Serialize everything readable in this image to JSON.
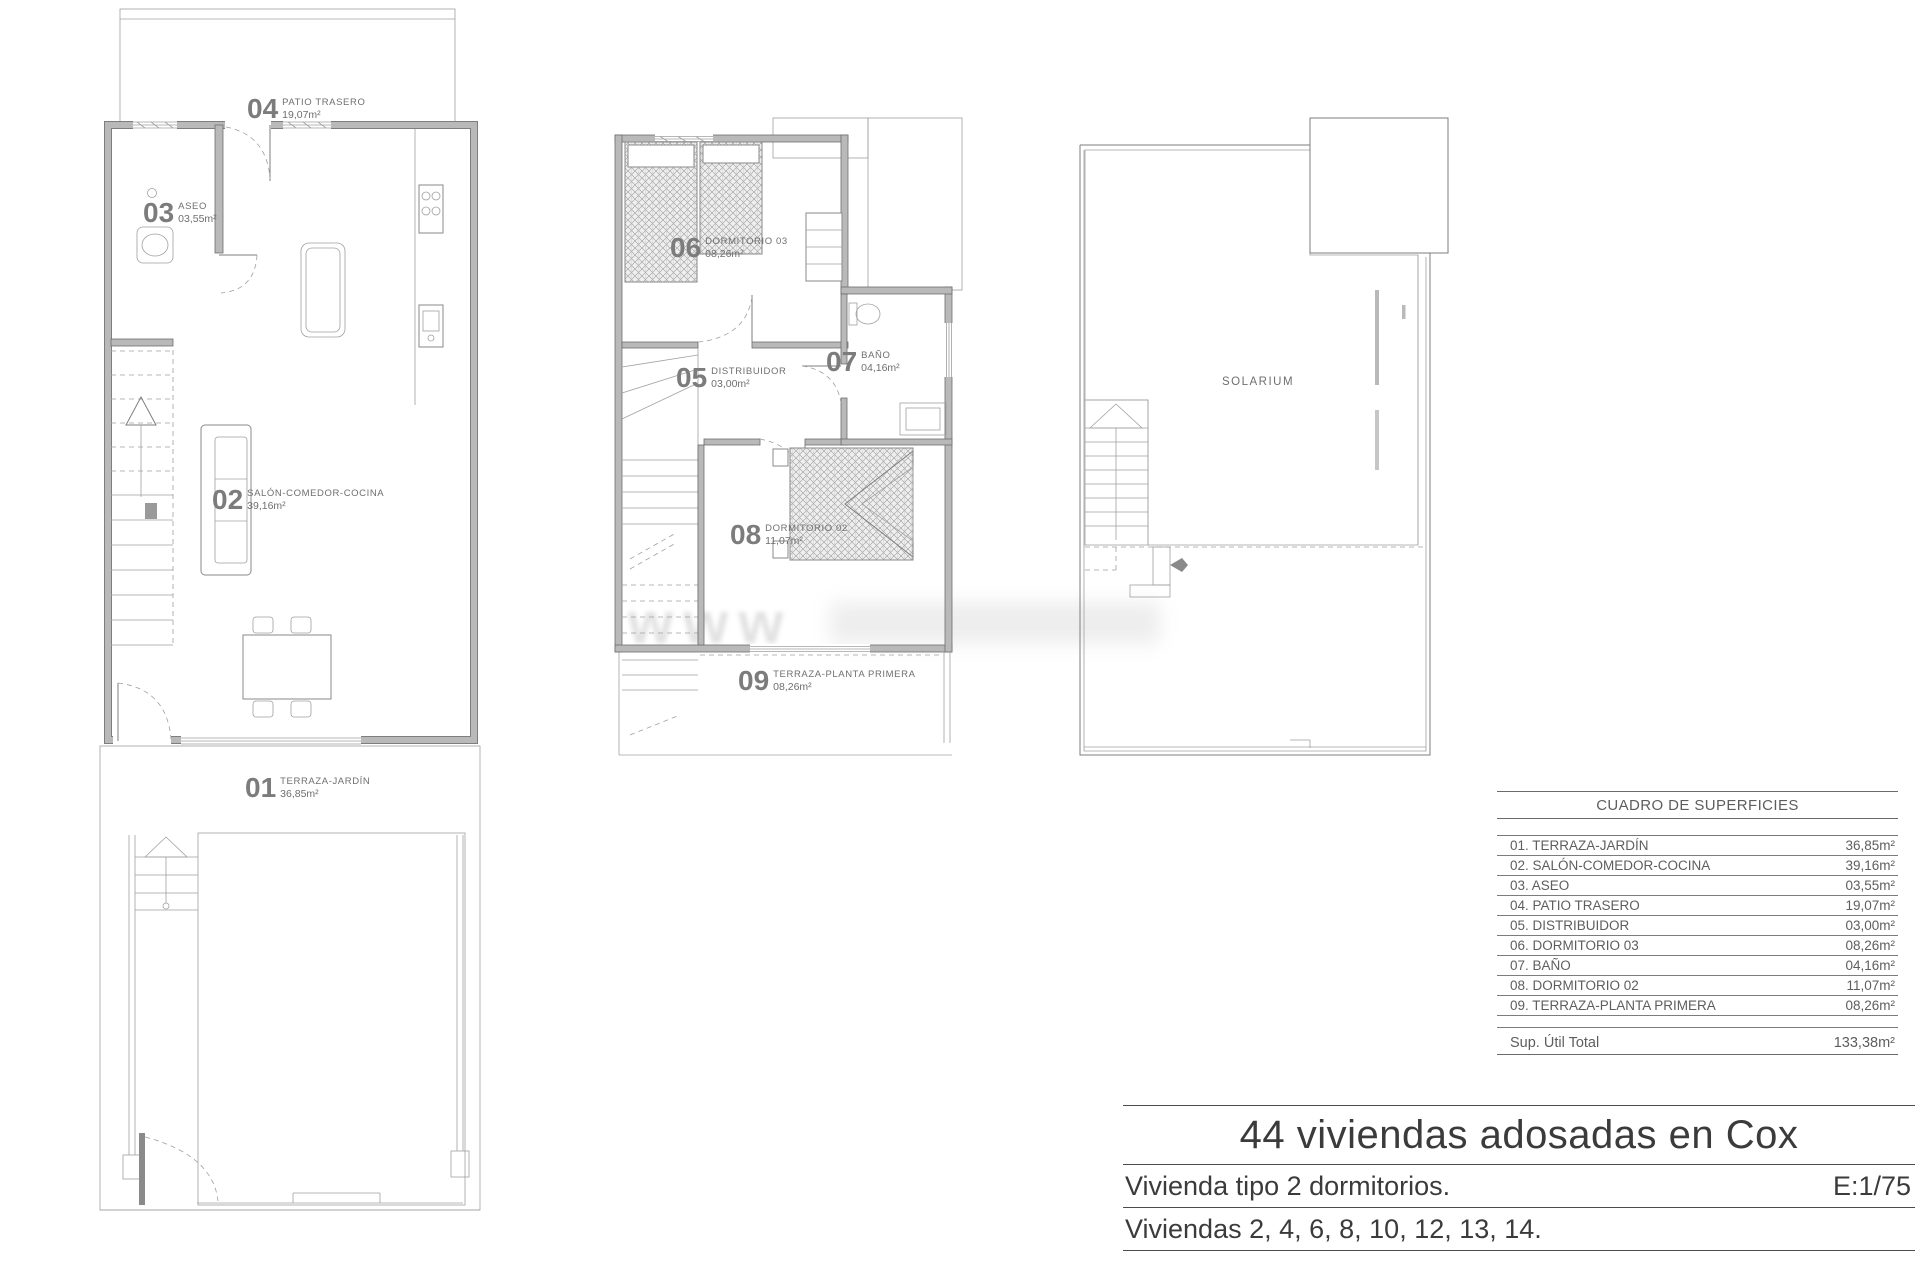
{
  "plans": {
    "ground": {
      "name": "planta-baja",
      "rooms": [
        {
          "num": "04",
          "name": "PATIO TRASERO",
          "area": "19,07m²"
        },
        {
          "num": "03",
          "name": "ASEO",
          "area": "03,55m²"
        },
        {
          "num": "02",
          "name": "SALÓN-COMEDOR-COCINA",
          "area": "39,16m²"
        },
        {
          "num": "01",
          "name": "TERRAZA-JARDÍN",
          "area": "36,85m²"
        }
      ]
    },
    "first": {
      "name": "planta-primera",
      "rooms": [
        {
          "num": "06",
          "name": "DORMITORIO 03",
          "area": "08,26m²"
        },
        {
          "num": "05",
          "name": "DISTRIBUIDOR",
          "area": "03,00m²"
        },
        {
          "num": "07",
          "name": "BAÑO",
          "area": "04,16m²"
        },
        {
          "num": "08",
          "name": "DORMITORIO 02",
          "area": "11,07m²"
        },
        {
          "num": "09",
          "name": "TERRAZA-PLANTA PRIMERA",
          "area": "08,26m²"
        }
      ]
    },
    "roof": {
      "label": "SOLARIUM"
    }
  },
  "surface_table": {
    "title": "CUADRO DE SUPERFICIES",
    "rows": [
      {
        "label": "01. TERRAZA-JARDÍN",
        "value": "36,85m²"
      },
      {
        "label": "02. SALÓN-COMEDOR-COCINA",
        "value": "39,16m²"
      },
      {
        "label": "03. ASEO",
        "value": "03,55m²"
      },
      {
        "label": "04. PATIO TRASERO",
        "value": "19,07m²"
      },
      {
        "label": "05. DISTRIBUIDOR",
        "value": "03,00m²"
      },
      {
        "label": "06. DORMITORIO 03",
        "value": "08,26m²"
      },
      {
        "label": "07. BAÑO",
        "value": "04,16m²"
      },
      {
        "label": "08. DORMITORIO 02",
        "value": "11,07m²"
      },
      {
        "label": "09. TERRAZA-PLANTA PRIMERA",
        "value": "08,26m²"
      }
    ],
    "total_label": "Sup. Útil Total",
    "total_value": "133,38m²"
  },
  "title_block": {
    "project": "44 viviendas adosadas en Cox",
    "dwelling_type": "Vivienda tipo 2 dormitorios.",
    "scale": "E:1/75",
    "units": "Viviendas 2, 4, 6, 8, 10, 12, 13, 14."
  },
  "watermark": "www"
}
